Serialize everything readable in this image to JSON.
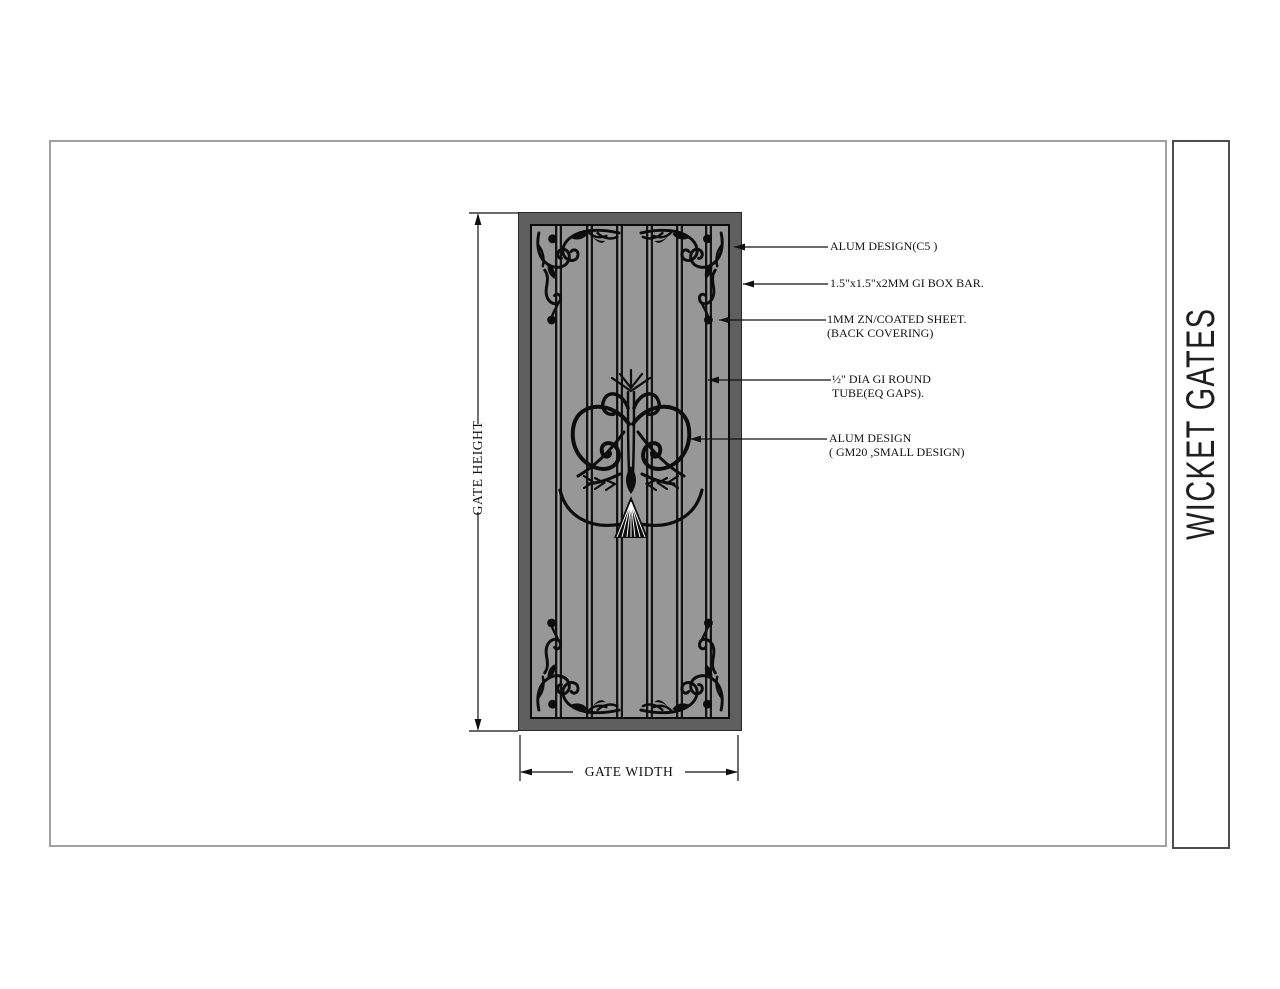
{
  "title_block": {
    "title": "WICKET GATES"
  },
  "dimensions": {
    "height_label": "GATE HEIGHT",
    "width_label": "GATE WIDTH"
  },
  "annotations": [
    {
      "line1": "ALUM DESIGN(C5 )",
      "line2": ""
    },
    {
      "line1": "1.5\"x1.5\"x2MM GI BOX BAR.",
      "line2": ""
    },
    {
      "line1": "1MM ZN/COATED SHEET.",
      "line2": "(BACK COVERING)"
    },
    {
      "line1": "½\" DIA GI ROUND",
      "line2": "TUBE(EQ GAPS)."
    },
    {
      "line1": "ALUM DESIGN",
      "line2": "( GM20 ,SMALL DESIGN)"
    }
  ],
  "colors": {
    "frame": "#5f5f5f",
    "panel": "#979797",
    "ornament": "#0d0d0d",
    "sheet_border": "#a0a0a0",
    "strip_border": "#4d4d4d",
    "line": "#111111"
  }
}
